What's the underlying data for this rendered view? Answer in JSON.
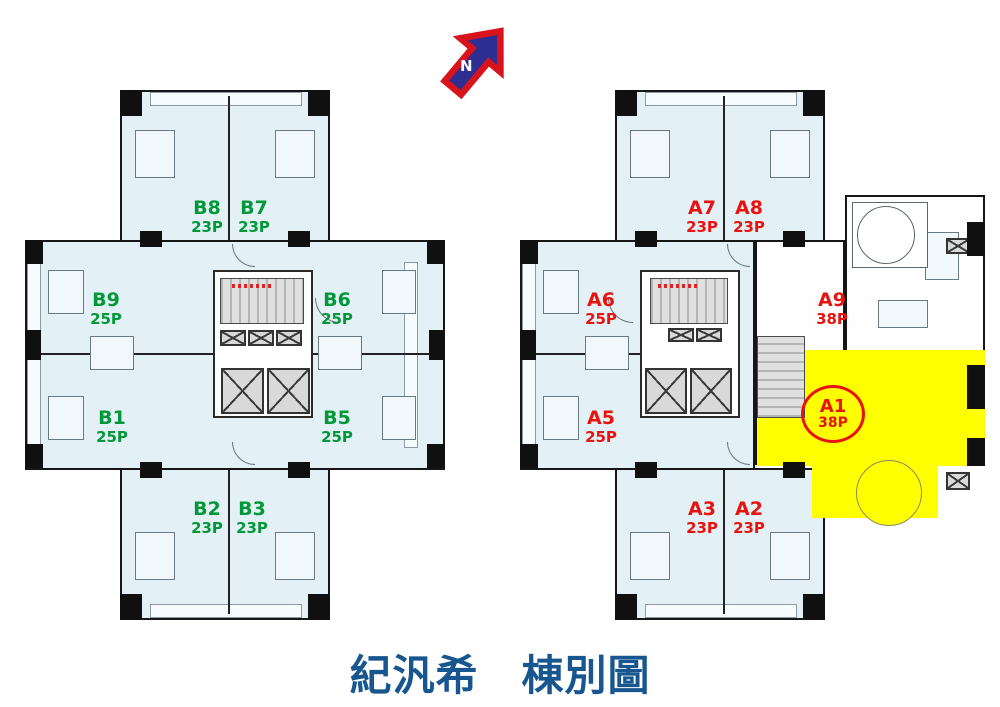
{
  "title": "紀汎希　棟別圖",
  "compass": {
    "label": "N"
  },
  "colors": {
    "unit_b_green": "#009838",
    "unit_a_red": "#e8120e",
    "highlight_yellow": "#ffff00",
    "title_blue": "#17568f",
    "floor_tint": "#e3f0f6"
  },
  "buildings": {
    "b": {
      "units": [
        {
          "id": "B8",
          "size": "23P"
        },
        {
          "id": "B7",
          "size": "23P"
        },
        {
          "id": "B9",
          "size": "25P"
        },
        {
          "id": "B6",
          "size": "25P"
        },
        {
          "id": "B1",
          "size": "25P"
        },
        {
          "id": "B5",
          "size": "25P"
        },
        {
          "id": "B2",
          "size": "23P"
        },
        {
          "id": "B3",
          "size": "23P"
        }
      ]
    },
    "a": {
      "highlighted_unit": "A1",
      "units": [
        {
          "id": "A7",
          "size": "23P"
        },
        {
          "id": "A8",
          "size": "23P"
        },
        {
          "id": "A6",
          "size": "25P"
        },
        {
          "id": "A9",
          "size": "38P"
        },
        {
          "id": "A5",
          "size": "25P"
        },
        {
          "id": "A1",
          "size": "38P"
        },
        {
          "id": "A3",
          "size": "23P"
        },
        {
          "id": "A2",
          "size": "23P"
        }
      ]
    }
  }
}
